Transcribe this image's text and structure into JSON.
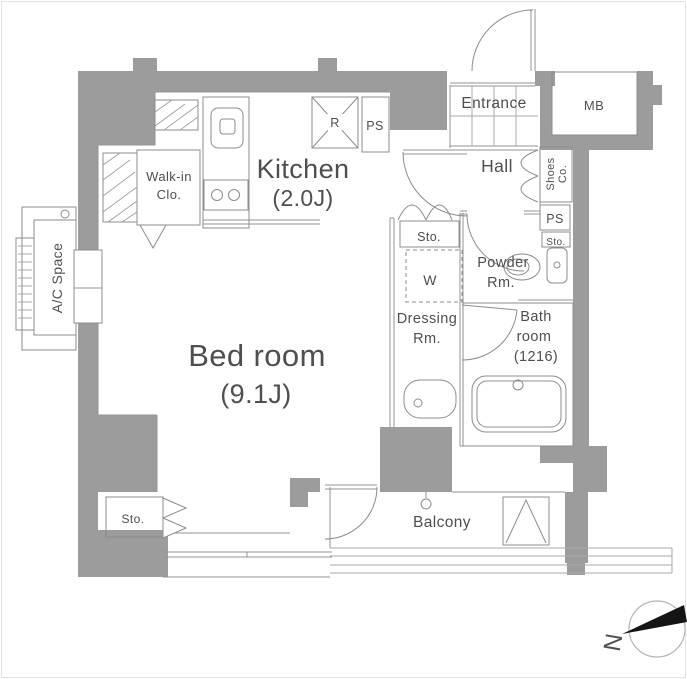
{
  "plan_title": "Apartment floor plan",
  "colors": {
    "wall": "#9c9c9c",
    "line": "#939393",
    "text": "#4f4f4f",
    "arrow": "#151515"
  },
  "rooms": {
    "kitchen": {
      "name": "Kitchen",
      "size": "(2.0J)"
    },
    "bedroom": {
      "name": "Bed room",
      "size": "(9.1J)"
    },
    "walkin": {
      "line1": "Walk-in",
      "line2": "Clo."
    },
    "ac_space": {
      "label": "A/C Space"
    },
    "entrance": {
      "label": "Entrance"
    },
    "mb": {
      "label": "MB"
    },
    "hall": {
      "label": "Hall"
    },
    "shoes": {
      "line1": "Shoes",
      "line2": "Co."
    },
    "ps_right": {
      "label": "PS"
    },
    "ps_kitchen": {
      "label": "PS"
    },
    "refrigerator": {
      "label": "R"
    },
    "sto_hall": {
      "label": "Sto."
    },
    "sto_powder": {
      "label": "Sto."
    },
    "sto_bedroom": {
      "label": "Sto."
    },
    "washer": {
      "label": "W"
    },
    "powder": {
      "line1": "Powder",
      "line2": "Rm."
    },
    "dressing": {
      "line1": "Dressing",
      "line2": "Rm."
    },
    "bath": {
      "line1": "Bath",
      "line2": "room",
      "line3": "(1216)"
    },
    "balcony": {
      "label": "Balcony"
    },
    "compass": {
      "label": "N"
    }
  }
}
